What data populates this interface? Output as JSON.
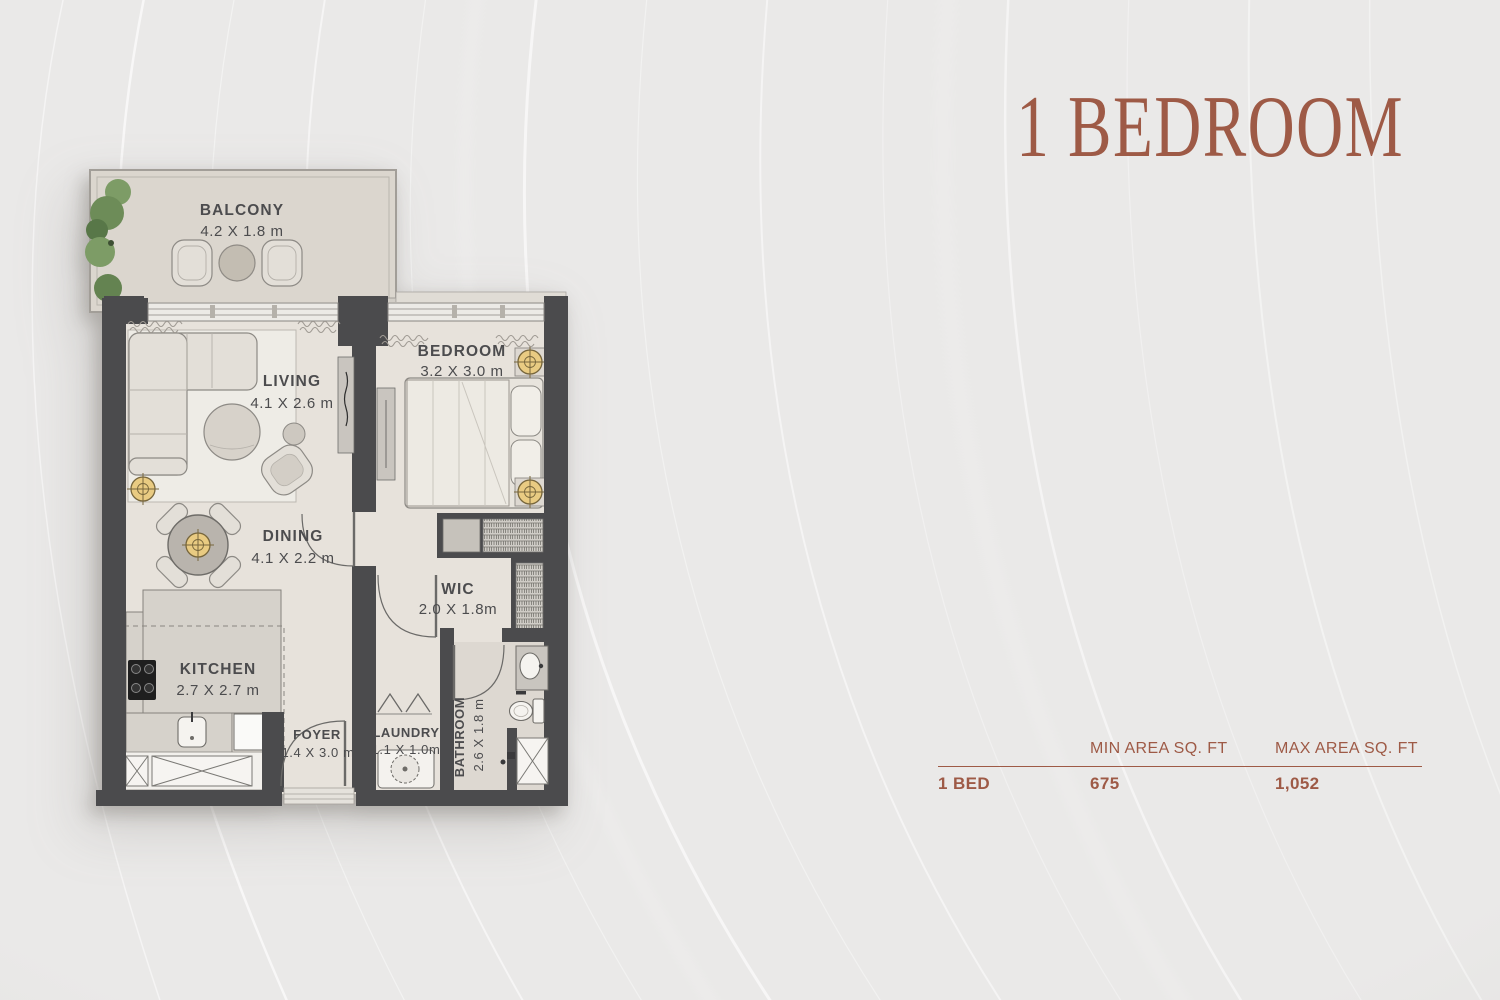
{
  "page": {
    "title": "1 BEDROOM"
  },
  "floor_plan": {
    "rooms": {
      "balcony": {
        "label": "BALCONY",
        "dims": "4.2 X 1.8 m"
      },
      "living": {
        "label": "LIVING",
        "dims": "4.1 X 2.6 m"
      },
      "bedroom": {
        "label": "BEDROOM",
        "dims": "3.2 X 3.0 m"
      },
      "dining": {
        "label": "DINING",
        "dims": "4.1 X 2.2 m"
      },
      "wic": {
        "label": "WIC",
        "dims": "2.0 X 1.8m"
      },
      "kitchen": {
        "label": "KITCHEN",
        "dims": "2.7 X 2.7 m"
      },
      "foyer": {
        "label": "FOYER",
        "dims": "1.4 X 3.0 m"
      },
      "laundry": {
        "label": "LAUNDRY",
        "dims": "1.1 X 1.0m"
      },
      "bathroom": {
        "label": "BATHROOM",
        "dims": "2.6 X 1.8 m"
      }
    }
  },
  "area_table": {
    "col_min": "MIN AREA SQ. FT",
    "col_max": "MAX AREA SQ. FT",
    "row_label": "1 BED",
    "min_value": "675",
    "max_value": "1,052"
  },
  "colors": {
    "accent": "#9E5A46",
    "wall": "#4B4B4D",
    "floor": "#E7E2DB",
    "gold": "#E9CB82",
    "plant": "#6D8C58",
    "text": "#4C4C4E",
    "background": "#EAE9E8"
  }
}
